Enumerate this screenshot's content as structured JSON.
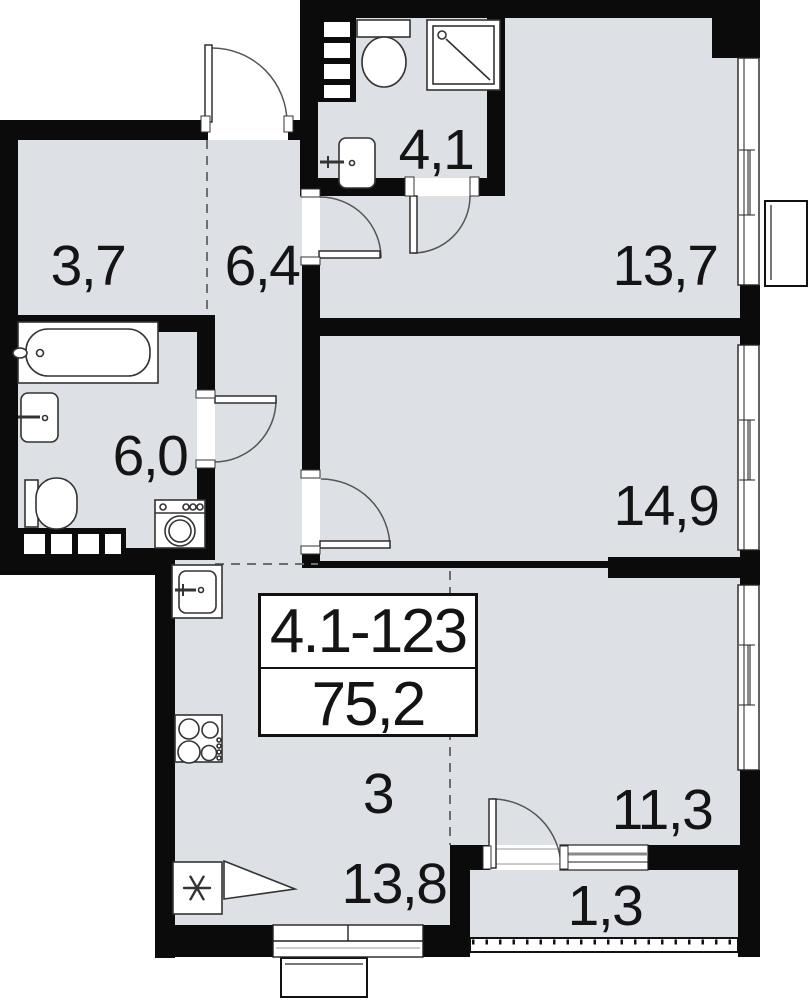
{
  "floorplan": {
    "unit": {
      "number": "4.1-123",
      "total_area": "75,2",
      "rooms_count": "3"
    },
    "rooms": [
      {
        "key": "wardrobe",
        "area": "3,7"
      },
      {
        "key": "hallway",
        "area": "6,4"
      },
      {
        "key": "bathroom-small",
        "area": "4,1"
      },
      {
        "key": "bedroom-top",
        "area": "13,7"
      },
      {
        "key": "bathroom-large",
        "area": "6,0"
      },
      {
        "key": "bedroom-middle",
        "area": "14,9"
      },
      {
        "key": "kitchen-living",
        "area": "13,8"
      },
      {
        "key": "bedroom-bottom",
        "area": "11,3"
      },
      {
        "key": "balcony",
        "area": "1,3"
      }
    ],
    "colors": {
      "room_fill": "#dde1e6",
      "wall": "#0b0b0b",
      "thin_line": "#333333",
      "glass": "#8a8a8a"
    },
    "icons": {
      "fridge": "snowflake-asterisk",
      "shower": "square-with-diagonal",
      "stove": "four-burners"
    }
  }
}
